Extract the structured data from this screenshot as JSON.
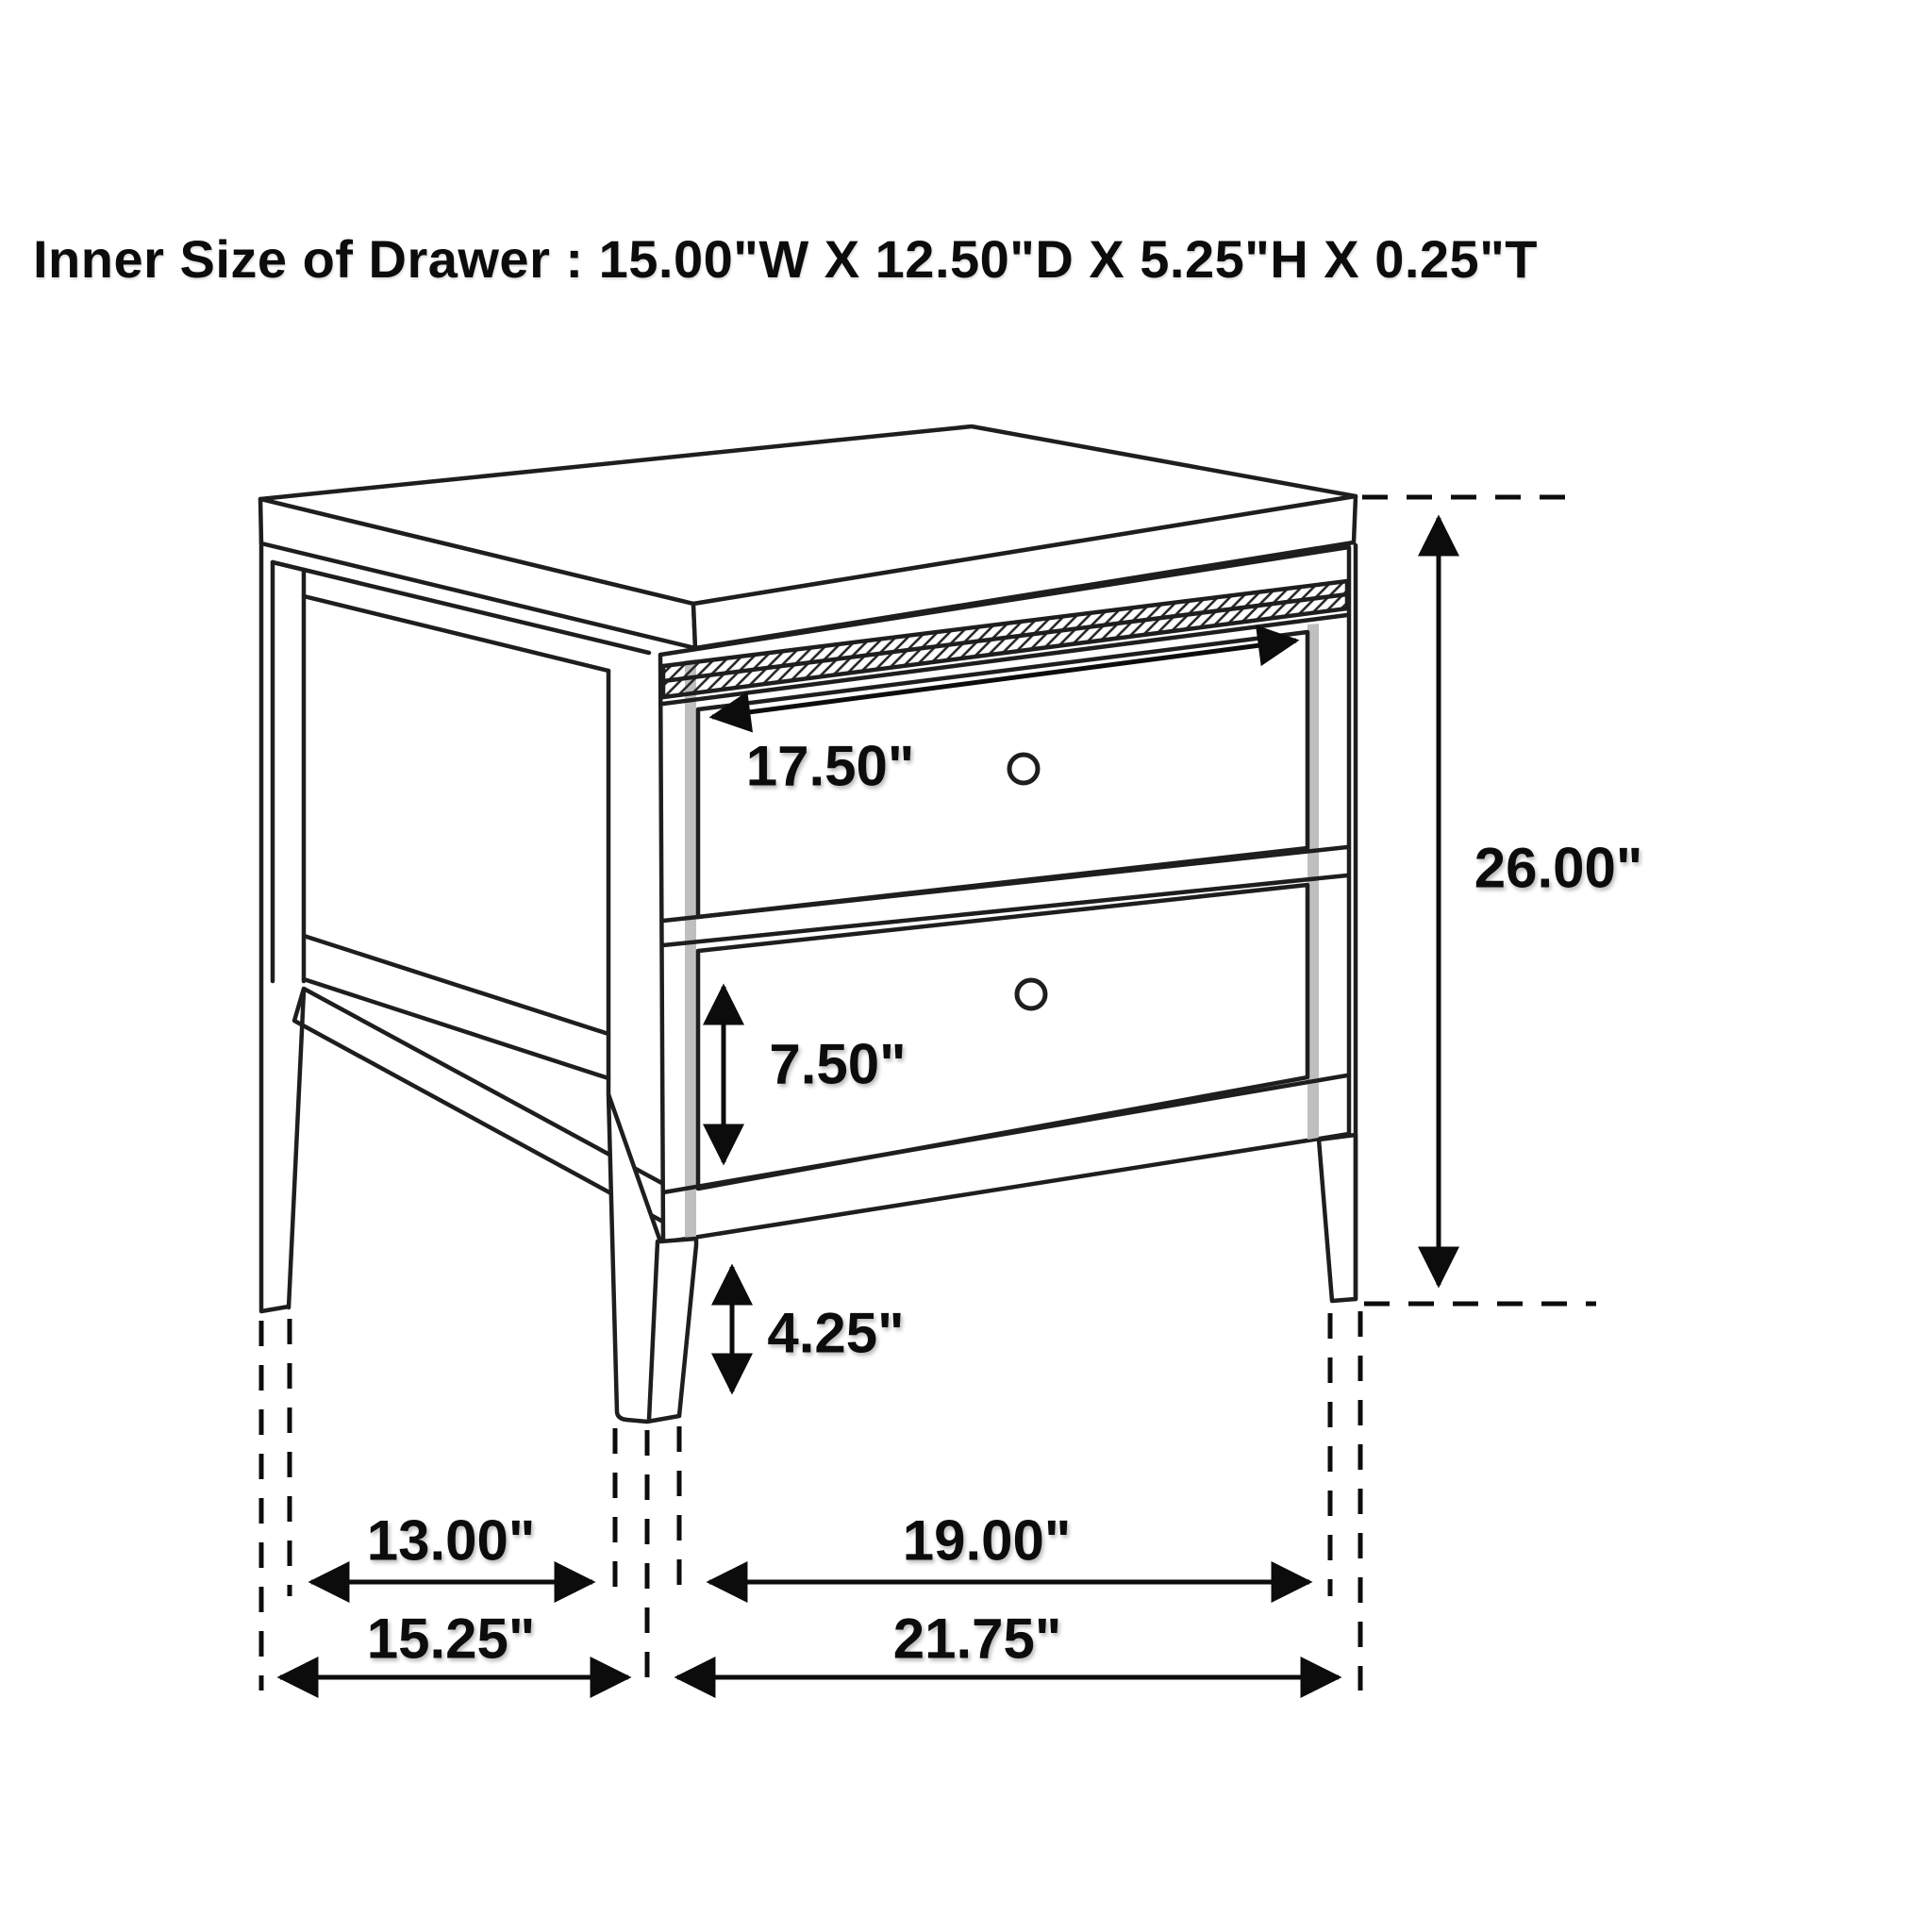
{
  "title": "Inner Size of Drawer : 15.00\"W X 12.50\"D X 5.25\"H X 0.25\"T",
  "dimension_labels": {
    "drawer_face_width": "17.50\"",
    "overall_height": "26.00\"",
    "bottom_drawer_height": "7.50\"",
    "leg_height": "4.25\"",
    "side_leg_clearance": "13.00\"",
    "side_overall_depth": "15.25\"",
    "front_leg_clearance": "19.00\"",
    "front_overall_width": "21.75\""
  }
}
